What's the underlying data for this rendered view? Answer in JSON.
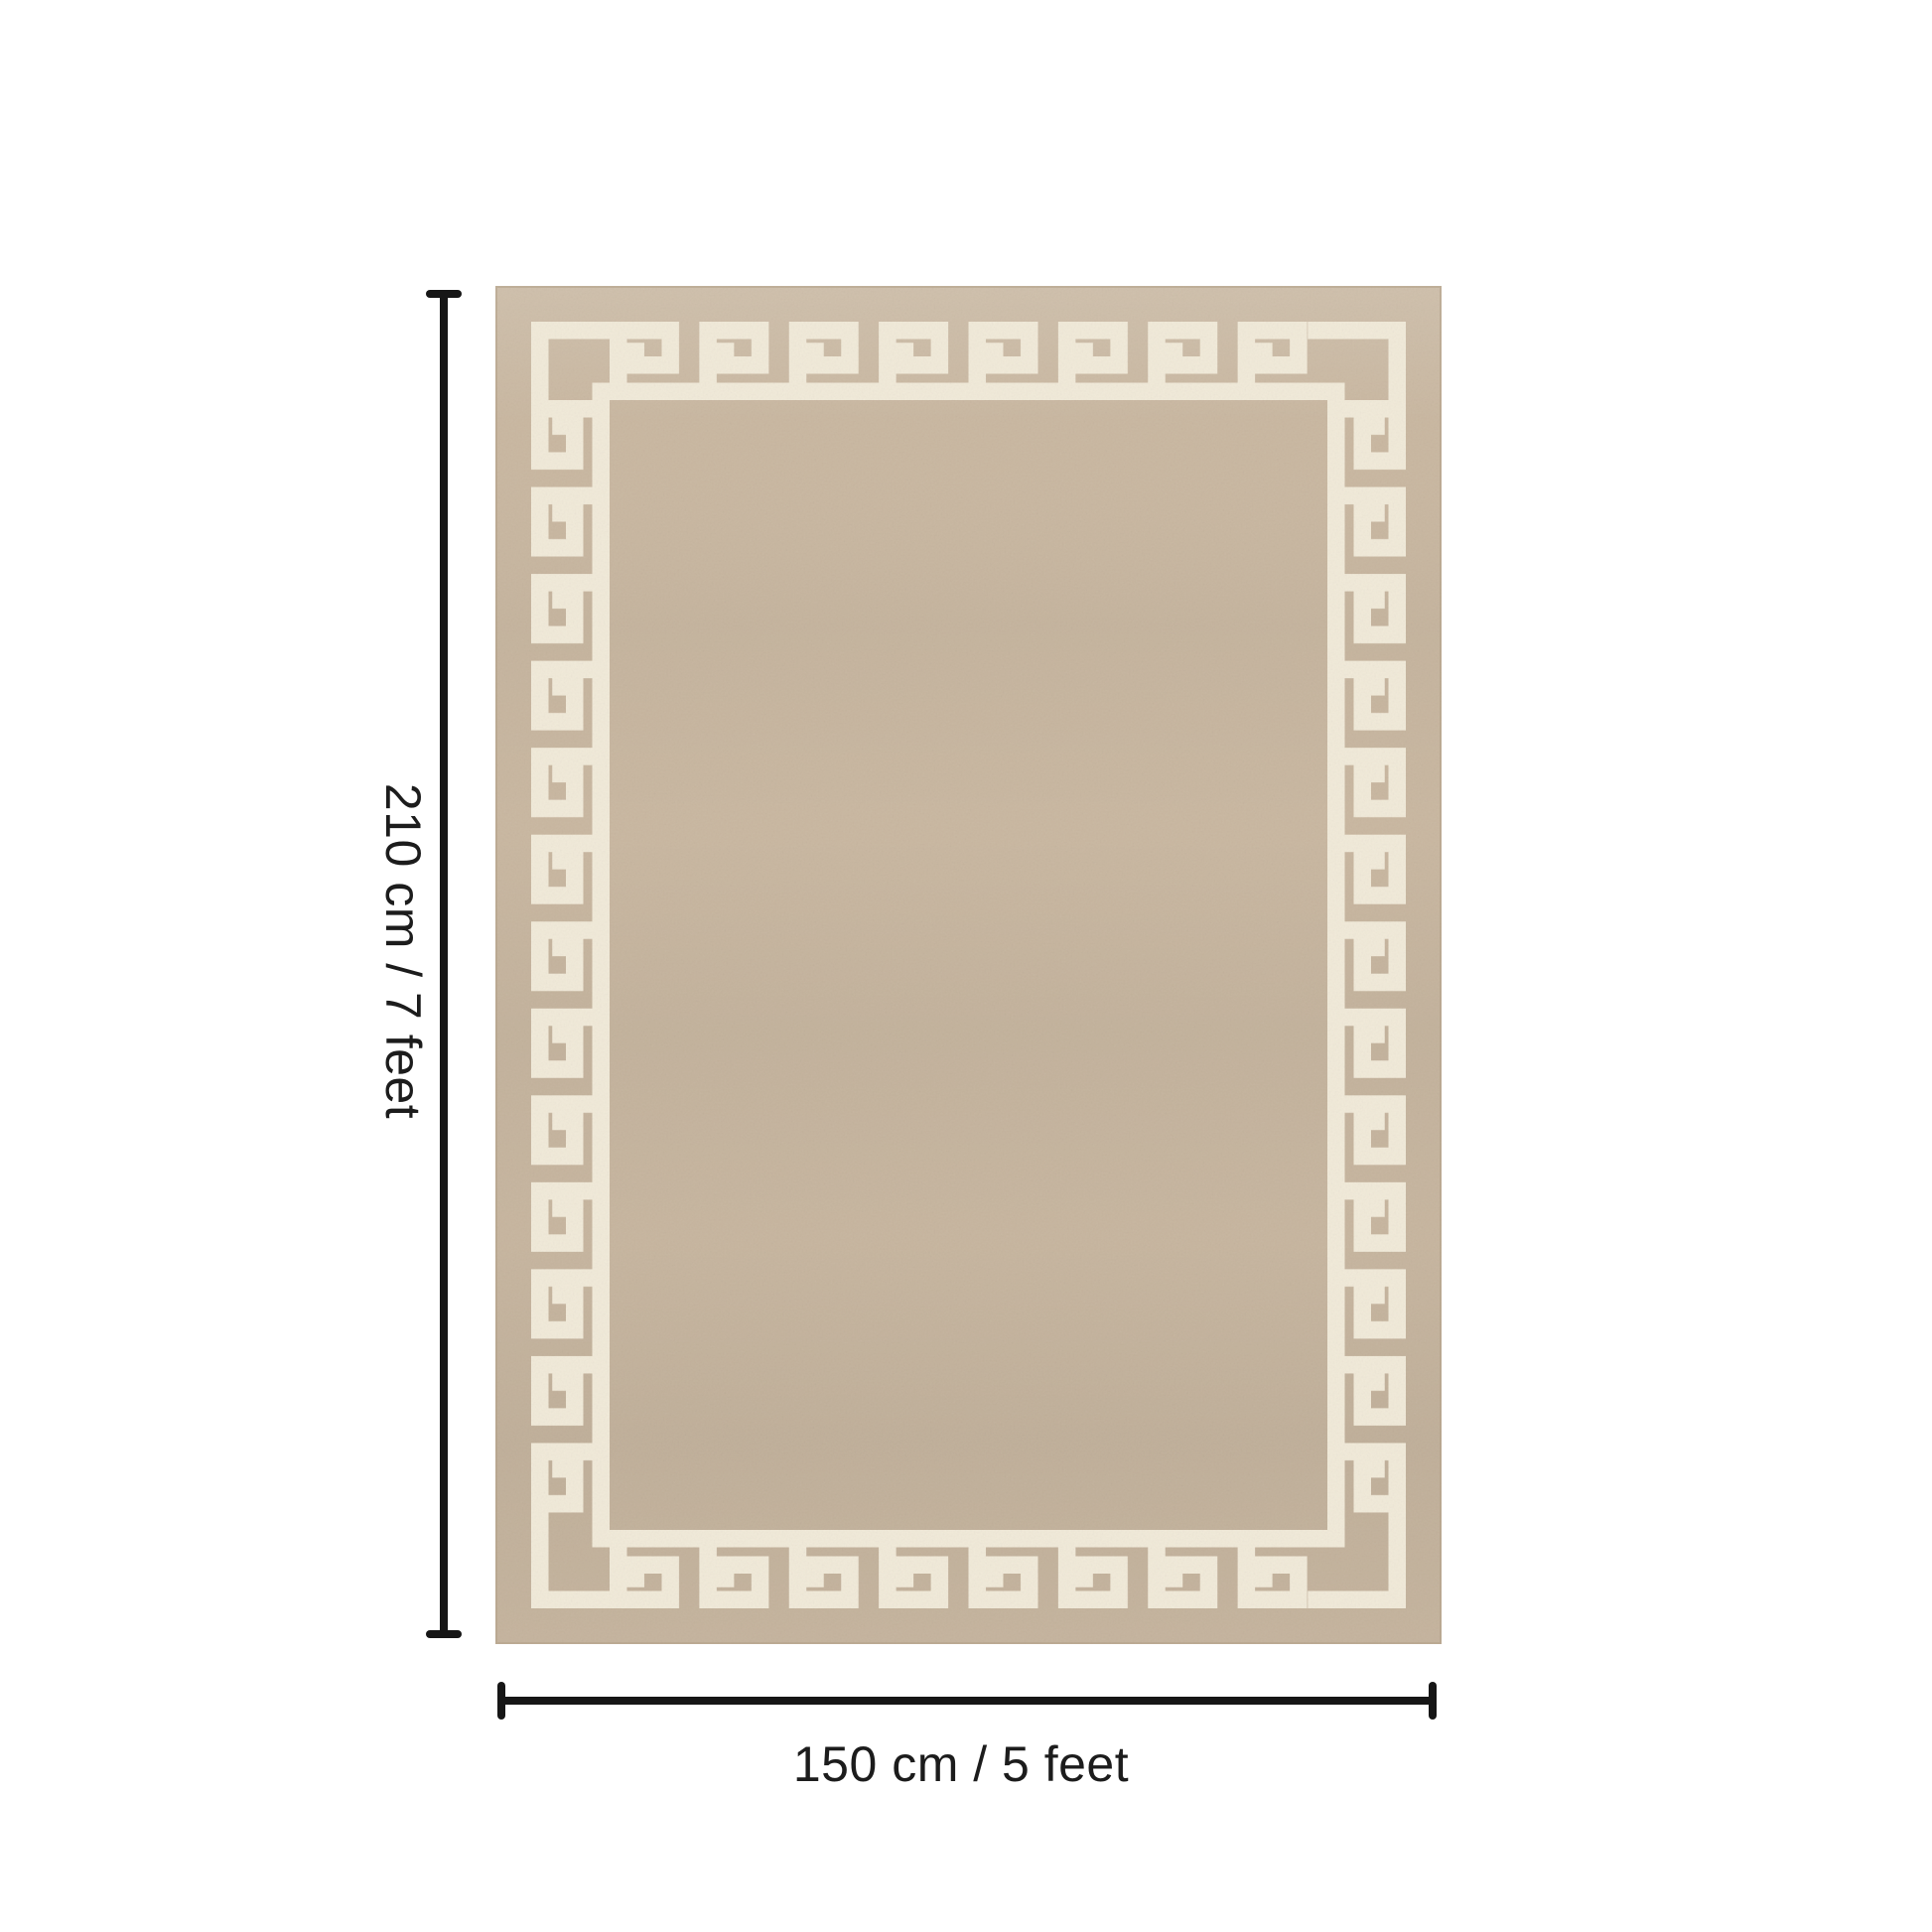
{
  "diagram": {
    "background_color": "#ffffff",
    "rug": {
      "pattern_name": "greek-key-border",
      "field_color": "#c9b7a0",
      "pattern_color": "#f1ead9",
      "edge_color": "#b3a189"
    },
    "dimension_lines": {
      "color": "#161616",
      "height": {
        "label": "210 cm / 7 feet"
      },
      "width": {
        "label": "150 cm / 5 feet"
      }
    }
  }
}
